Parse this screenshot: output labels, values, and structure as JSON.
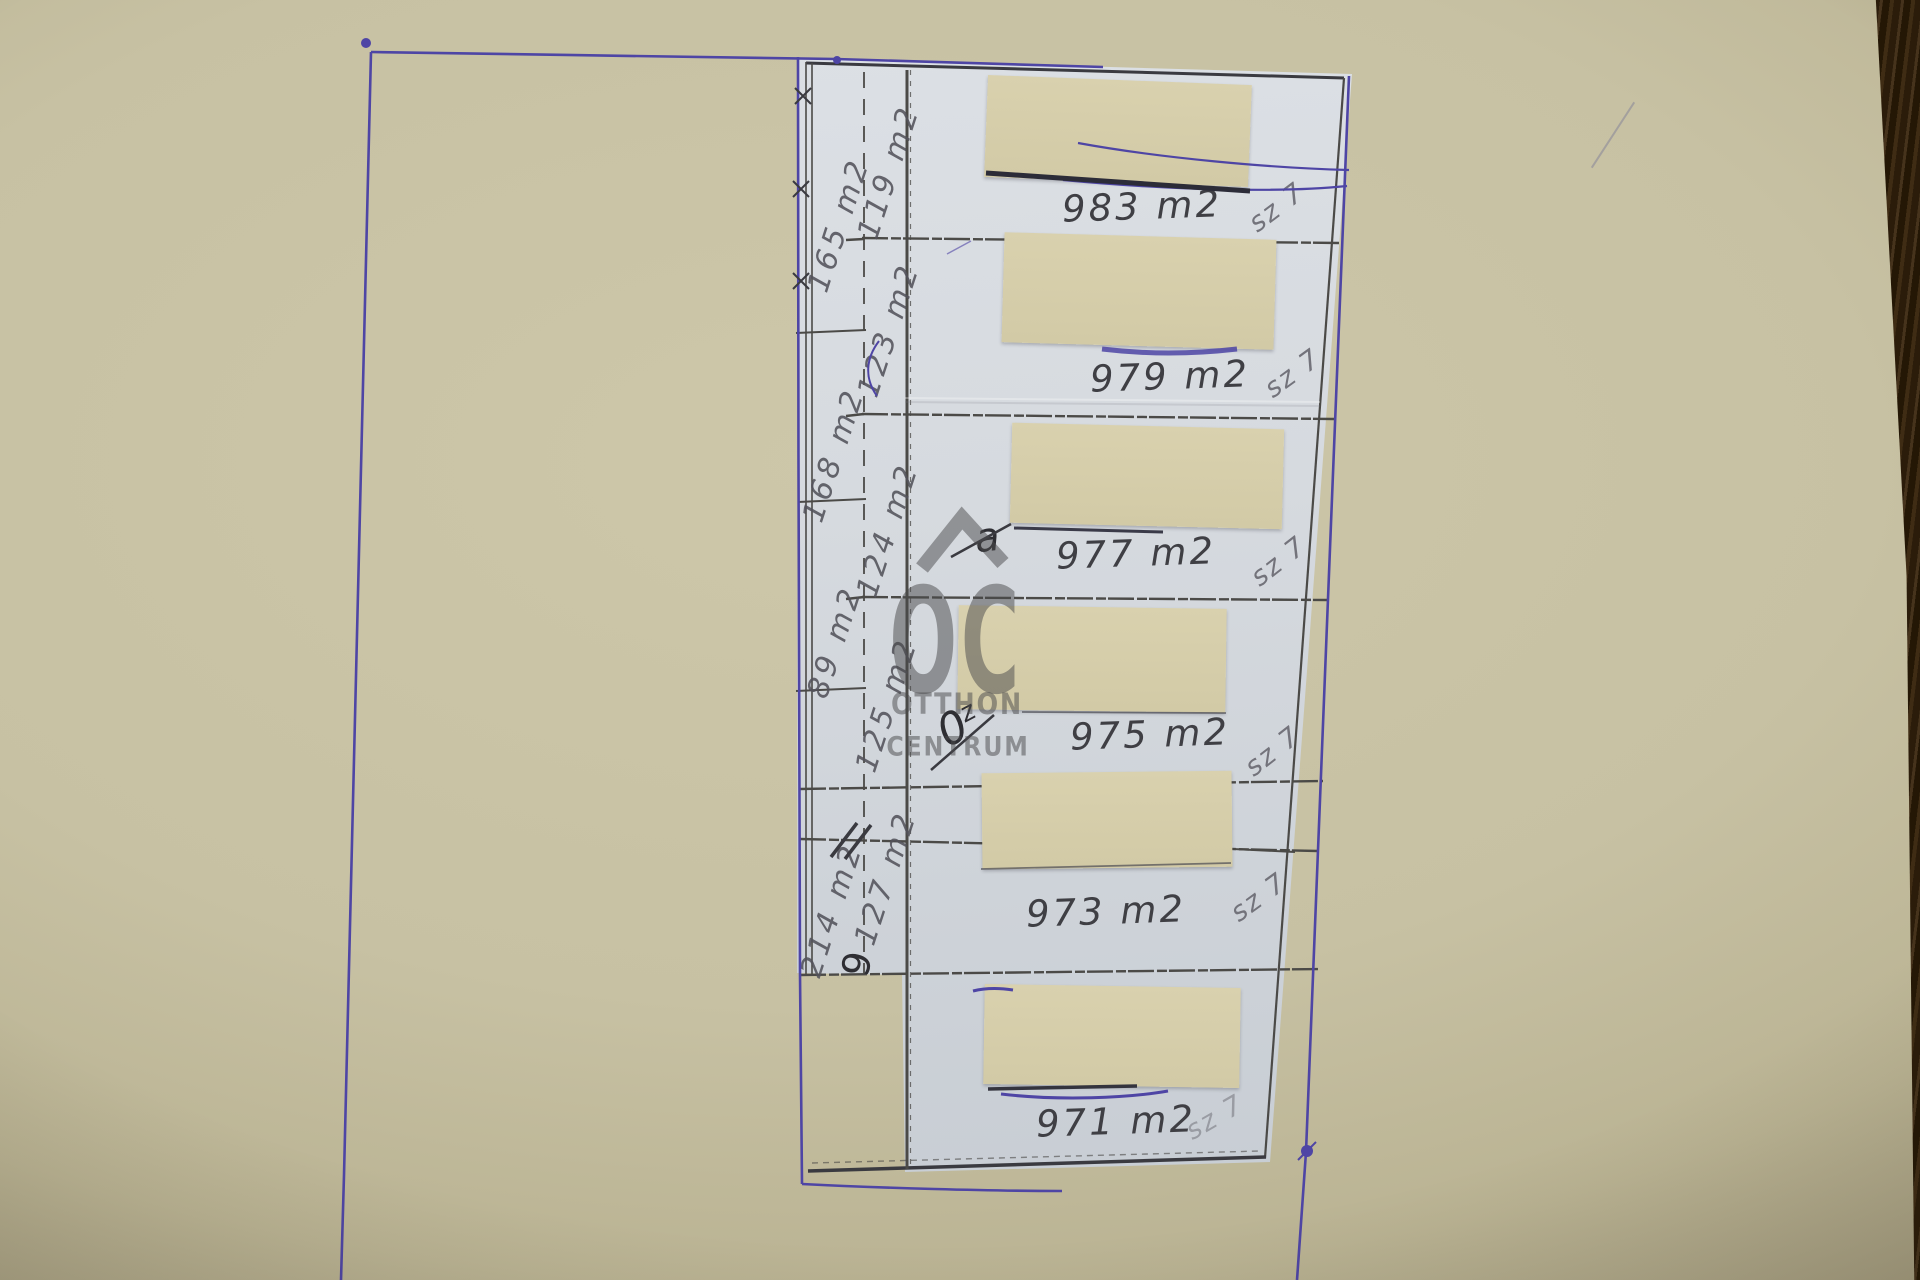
{
  "parcels": [
    {
      "area": "983 m2",
      "code": "sz 7"
    },
    {
      "area": "979 m2",
      "code": "sz 7"
    },
    {
      "area": "977 m2",
      "code": "sz 7"
    },
    {
      "area": "975 m2",
      "code": "sz 7"
    },
    {
      "area": "973 m2",
      "code": "sz 7"
    },
    {
      "area": "971 m2",
      "code": "sz 7"
    }
  ],
  "measurements": {
    "outer": [
      "165 m2",
      "168 m2",
      "89 m2",
      "214 m2"
    ],
    "inner": [
      "119 m2",
      "123 m2",
      "124 m2",
      "125 m2",
      "127 m2"
    ]
  },
  "handwritten": {
    "crossed_a": "a",
    "crossed_o": "0",
    "crossed_z": "z",
    "nine": "9"
  },
  "watermark": {
    "monogram": "OC",
    "line1": "OTTHON",
    "line2": "CENTRUM"
  },
  "colors": {
    "pen_ink": "#4e45a5",
    "pencil": "#4b4a47",
    "pencil_dark": "#3a3a40",
    "paper": "#d7dbe0",
    "patch": "#d6ceab",
    "watermark_gray": "#4a4a4c"
  }
}
